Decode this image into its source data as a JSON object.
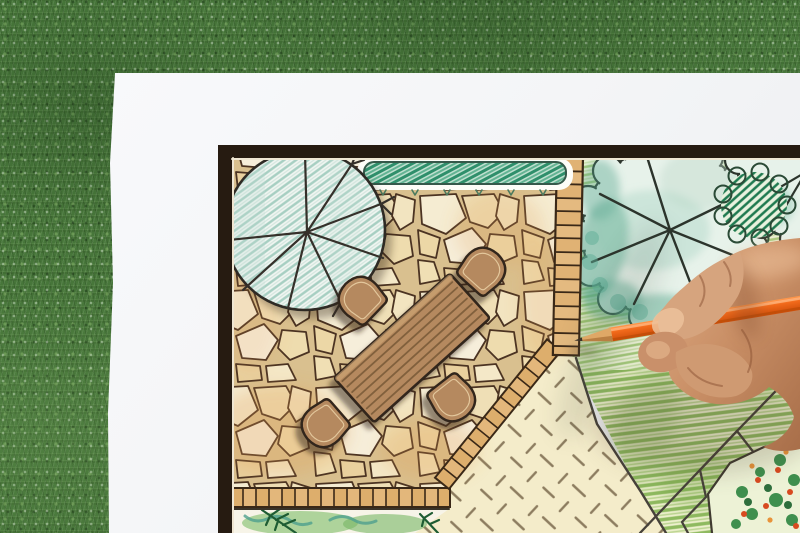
{
  "scene": {
    "title": "Hand drawing a garden landscape design plan with an orange colored pencil on paper over a grass lawn",
    "background": {
      "name": "grass-lawn",
      "base_color": "#47763a"
    },
    "paper": {
      "name": "drawing-paper-sheet",
      "color": "#f5f6f8"
    },
    "plan": {
      "frame_color": "#261b11",
      "inner_margin_color": "#efe6d2",
      "patio": {
        "stone_fill": "#f3e9cd",
        "stone_outline": "#4b3322",
        "grout": "#d9c08f",
        "tint": "#e29a4e"
      },
      "brick_edging": {
        "fill": "#ddae6c",
        "fill_alt": "#e8c088",
        "outline": "#3a2817"
      },
      "shade_tree": {
        "fill": "#f1f6f2",
        "hatch_color": "#a7cfc2",
        "outline": "#2e2a24",
        "branch_color": "#35302a"
      },
      "hedge": {
        "scribble_dark": "#2f8f6b",
        "scribble_light": "#63b393",
        "outline": "#35594a"
      },
      "dining_set": {
        "wood_fill": "#b5895e",
        "outline": "#32251a",
        "plank_line": "#81603c",
        "inner_line": "#e3c79c",
        "chair_count": 4,
        "table_count": 1
      },
      "tree_canopies": {
        "wash_teal": "#55a68c",
        "wash_teal_light": "#7fbfa8",
        "canopy_fill": "#e7f2ea",
        "crayon_green": "#a6ca7c",
        "branch_line": "#2c342c"
      },
      "shrub_hatch_color": "#1f7a50",
      "lawn": {
        "stroke_green": "#8fba60",
        "base": "#edf0cd",
        "path_line": "#46413a"
      },
      "ground_cover": {
        "base": "#f4ecca",
        "dash_color": "#8d7d60"
      },
      "planting_bed": {
        "wash_green": "#8fc57a",
        "wash_teal": "#4fa08e",
        "fern_color": "#1e5c33"
      },
      "flower_bed": {
        "leaf_green": "#3f8f4e",
        "flower_red": "#d84a20",
        "flower_orange": "#e8933a"
      }
    },
    "pencil": {
      "name": "orange-colored-pencil",
      "barrel_color": "#f26a1b",
      "barrel_shade": "#c24e08",
      "wood_color": "#dfa866",
      "tip_color": "#3c3228"
    },
    "hand": {
      "name": "artist-hand",
      "skin_light": "#dcab84",
      "skin_mid": "#c9906a",
      "skin_shadow": "#a86e49"
    }
  }
}
